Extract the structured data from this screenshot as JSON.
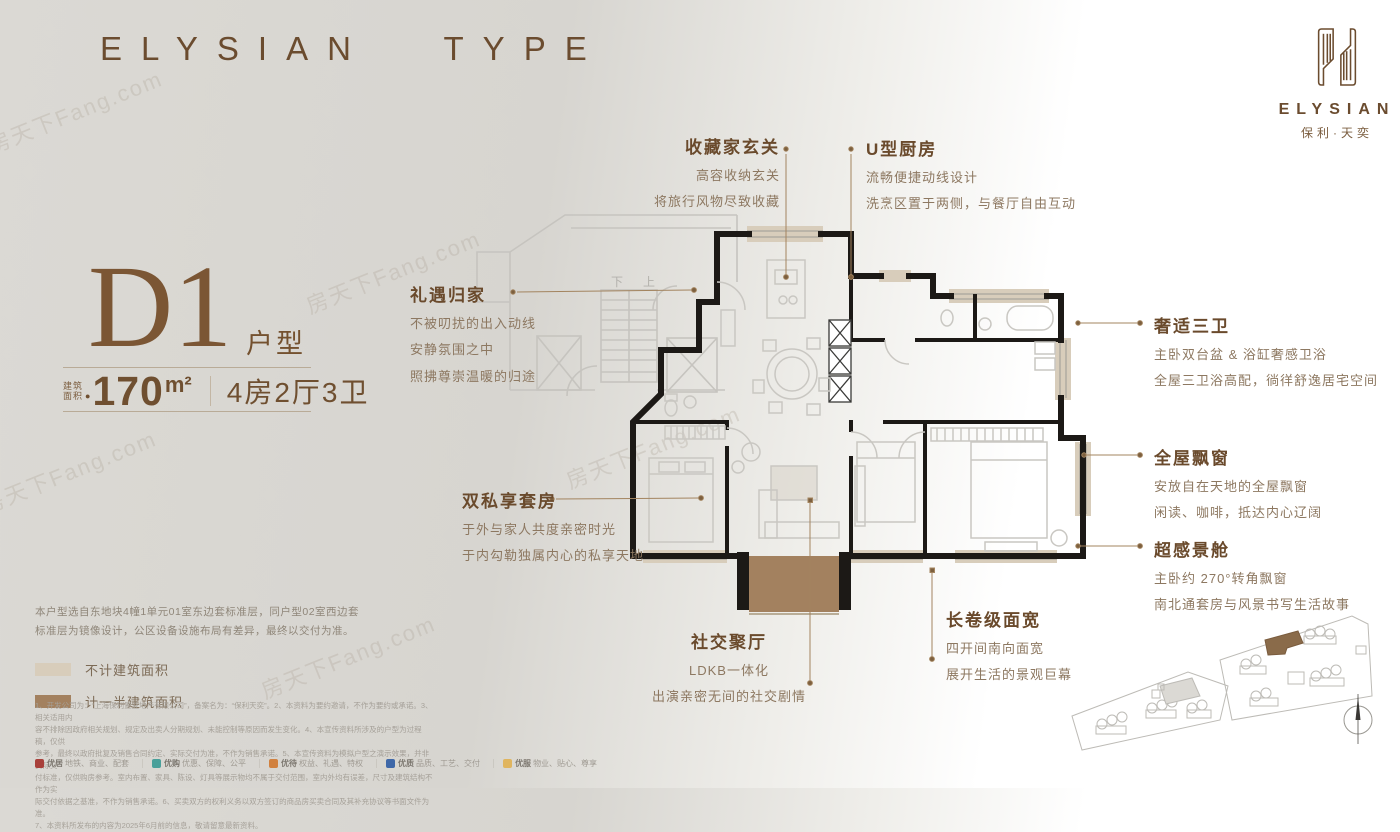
{
  "header": {
    "brand_title": "ELYSIAN TYPE"
  },
  "logo": {
    "name_en": "ELYSIAN",
    "name_cn": "保利·天奕"
  },
  "unit": {
    "type_code": "D1",
    "type_suffix": "户型",
    "area_label_line1": "建筑",
    "area_label_line2": "面积",
    "area_dot": "●",
    "area_value": "170",
    "area_unit": "m²",
    "layout": "4房2厅3卫"
  },
  "plan": {
    "stair_down": "下",
    "stair_up": "上"
  },
  "annotations": [
    {
      "title": "收藏家玄关",
      "lines": [
        "高容收纳玄关",
        "将旅行风物尽致收藏"
      ]
    },
    {
      "title": "U型厨房",
      "lines": [
        "流畅便捷动线设计",
        "洗烹区置于两侧，与餐厅自由互动"
      ]
    },
    {
      "title": "礼遇归家",
      "lines": [
        "不被叨扰的出入动线",
        "安静氛围之中",
        "照拂尊崇温暖的归途"
      ]
    },
    {
      "title": "奢适三卫",
      "lines": [
        "主卧双台盆 & 浴缸奢感卫浴",
        "全屋三卫浴高配，徜徉舒逸居宅空间"
      ]
    },
    {
      "title": "全屋飘窗",
      "lines": [
        "安放自在天地的全屋飘窗",
        "闲读、咖啡，抵达内心辽阔"
      ]
    },
    {
      "title": "超感景舱",
      "lines": [
        "主卧约 270°转角飘窗",
        "南北通套房与风景书写生活故事"
      ]
    },
    {
      "title": "双私享套房",
      "lines": [
        "于外与家人共度亲密时光",
        "于内勾勒独属内心的私享天地"
      ]
    },
    {
      "title": "社交聚厅",
      "lines": [
        "LDKB一体化",
        "出演亲密无间的社交剧情"
      ]
    },
    {
      "title": "长卷级面宽",
      "lines": [
        "四开间南向面宽",
        "展开生活的景观巨幕"
      ]
    }
  ],
  "disclaimer": "本户型选自东地块4幢1单元01室东边套标准层，同户型02室西边套标准层为镜像设计，公区设备设施布局有差异，最终以交付为准。",
  "legend": [
    {
      "label": "不计建筑面积",
      "color": "#d8cdbb"
    },
    {
      "label": "计一半建筑面积",
      "color": "#a3815f"
    }
  ],
  "fine_print": [
    "1、开发公司为：“上海保利置业地产有限公司”，备案名为：“保利天奕”。2、本资料为要约邀请，不作为要约或承诺。3、相关适用内",
    "容不排除因政府相关规划、规定及出卖人分期规划、未能控制等原因而发生变化。4、本宣传资料所涉及的户型为过程稿，仅供",
    "参考，最终以政府批复及销售合同约定、实际交付为准，不作为销售承诺。5、本宣传资料为模拟户型之演示效果，并非实际交",
    "付标准，仅供购房参考。室内布置、家具、陈设、灯具等展示物均不属于交付范围，室内外均有误差，尺寸及建筑结构不作为实",
    "际交付依据之基准，不作为销售承诺。6、买卖双方的权利义务以双方签订的商品房买卖合同及其补充协议等书面文件为准。",
    "7、本资料所发布的内容为2025年6月前的信息，敬请留意最新资料。"
  ],
  "footer": {
    "divider": "｜",
    "items": [
      {
        "name": "优居",
        "sub": "地铁、商业、配套",
        "color": "#a8403a"
      },
      {
        "name": "优购",
        "sub": "优惠、保障、公平",
        "color": "#49a09a"
      },
      {
        "name": "优待",
        "sub": "权益、礼遇、特权",
        "color": "#d1813f"
      },
      {
        "name": "优质",
        "sub": "品质、工艺、交付",
        "color": "#3f68a8"
      },
      {
        "name": "优服",
        "sub": "物业、贴心、尊享",
        "color": "#e0b55f"
      }
    ]
  },
  "watermark": "房天下Fang.com",
  "colors": {
    "accent_brown": "#6b4c2f",
    "body_brown": "#8d7861",
    "wall_black": "#1c1916",
    "no_area_beige": "#d8cdbb",
    "half_area_brown": "#a3815f",
    "background_gray": "#dbd9d4"
  }
}
